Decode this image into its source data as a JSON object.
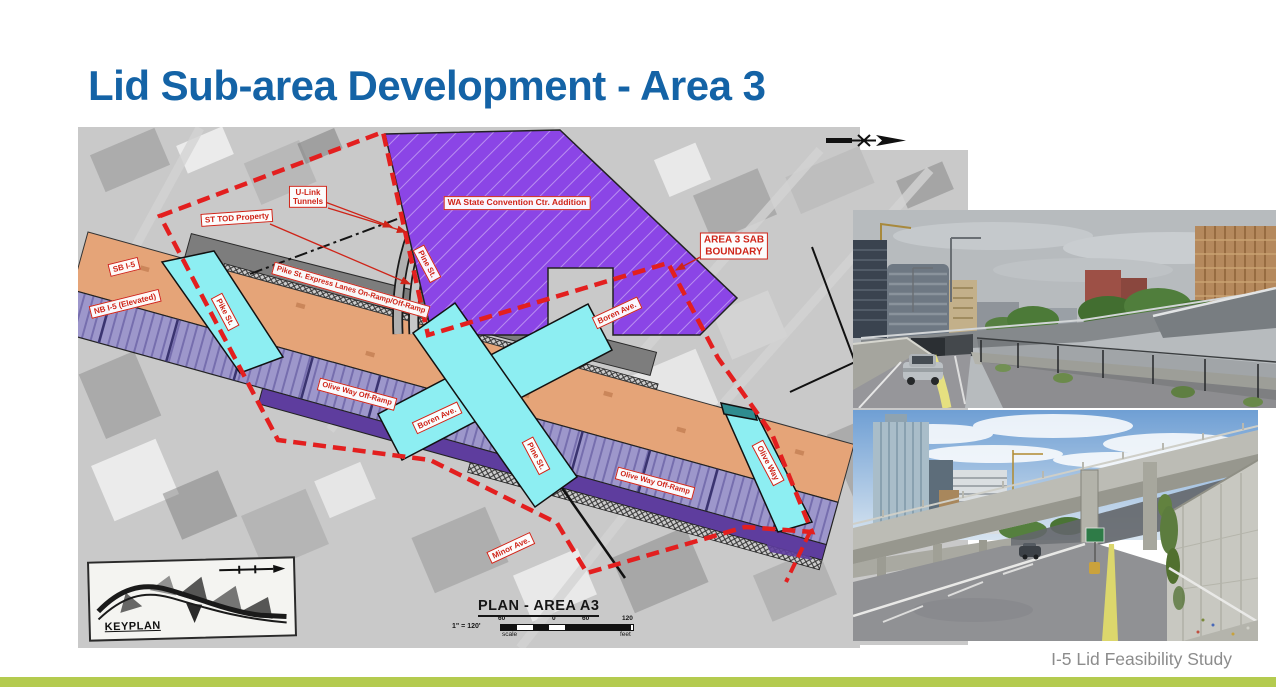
{
  "slide": {
    "title": "Lid Sub-area Development - Area 3",
    "footer": "I-5 Lid Feasibility Study"
  },
  "colors": {
    "title_blue": "#1463a6",
    "accent_green": "#b4cb4f",
    "footer_gray": "#8c8c8c",
    "boundary_red": "#e31f1f",
    "label_red": "#cf2418",
    "lid_orange": "#e5a478",
    "nb_lavender": "#9d97cb",
    "ramp_darkpurple": "#5e3d9e",
    "street_cyan": "#8deef2",
    "convention_purple": "#8b45e6",
    "aerial_gray": "#c9c9c9",
    "teal_patch": "#2f8c8f"
  },
  "map": {
    "labels": {
      "st_tod": "ST TOD Property",
      "ulink": "U-Link\nTunnels",
      "convention": "WA State Convention Ctr. Addition",
      "area3_boundary": "AREA 3 SAB\nBOUNDARY",
      "pine_upper": "Pine St.",
      "pike_left": "Pike St.",
      "sb_i5": "SB I-5",
      "nb_i5": "NB I-5 (Elevated)",
      "pike_express": "Pike St. Express Lanes On-Ramp/Off-Ramp",
      "olive_off_a": "Olive Way Off-Ramp",
      "olive_off_b": "Olive Way Off-Ramp",
      "boren_a": "Boren Ave.",
      "boren_b": "Boren Ave.",
      "pine_center": "Pine St.",
      "olive_way": "Olive Way",
      "minor": "Minor Ave."
    },
    "keyplan_label": "KEYPLAN",
    "plan_title": "PLAN - AREA A3",
    "scale": {
      "ratio": "1\" = 120'",
      "ticks": [
        "60",
        "0",
        "60",
        "120"
      ],
      "left_caption": "scale",
      "right_caption": "feet"
    }
  }
}
